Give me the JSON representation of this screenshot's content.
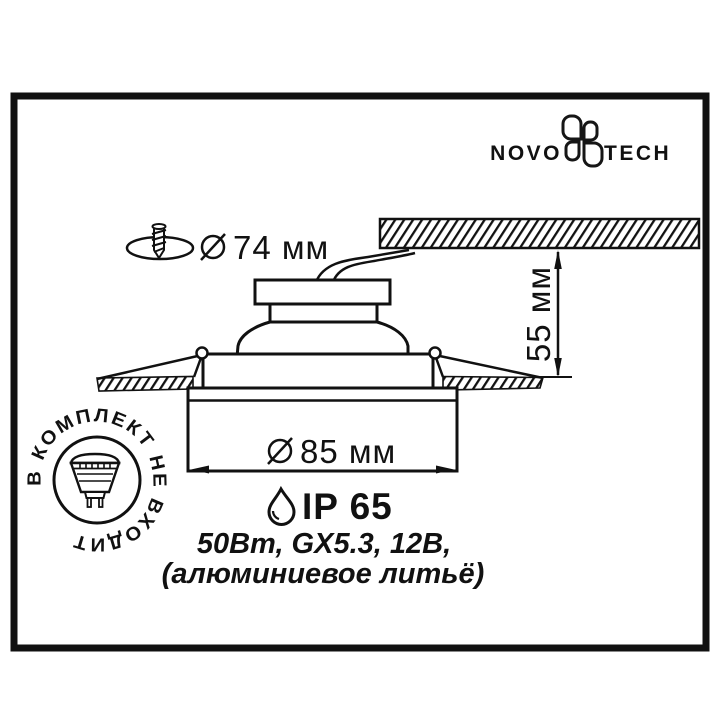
{
  "brand": {
    "logo_left": "NOVO",
    "logo_right": "TECH"
  },
  "dimensions": {
    "cutout_diameter": "74 мм",
    "recess_depth": "55 мм",
    "outer_diameter": "85 мм"
  },
  "specs": {
    "ip_rating": "IP 65",
    "electrical": "50Вт, GX5.3, 12В,",
    "material": "(алюминиевое литьё)"
  },
  "stamp": {
    "text": "В КОМПЛЕКТ НЕ ВХОДИТ"
  },
  "icons": {
    "diameter_symbol": "diameter-icon",
    "water_drop": "water-drop-icon",
    "screw": "screw-icon",
    "lamp": "mr16-lamp-icon"
  },
  "colors": {
    "ink": "#111111",
    "background": "#ffffff"
  }
}
